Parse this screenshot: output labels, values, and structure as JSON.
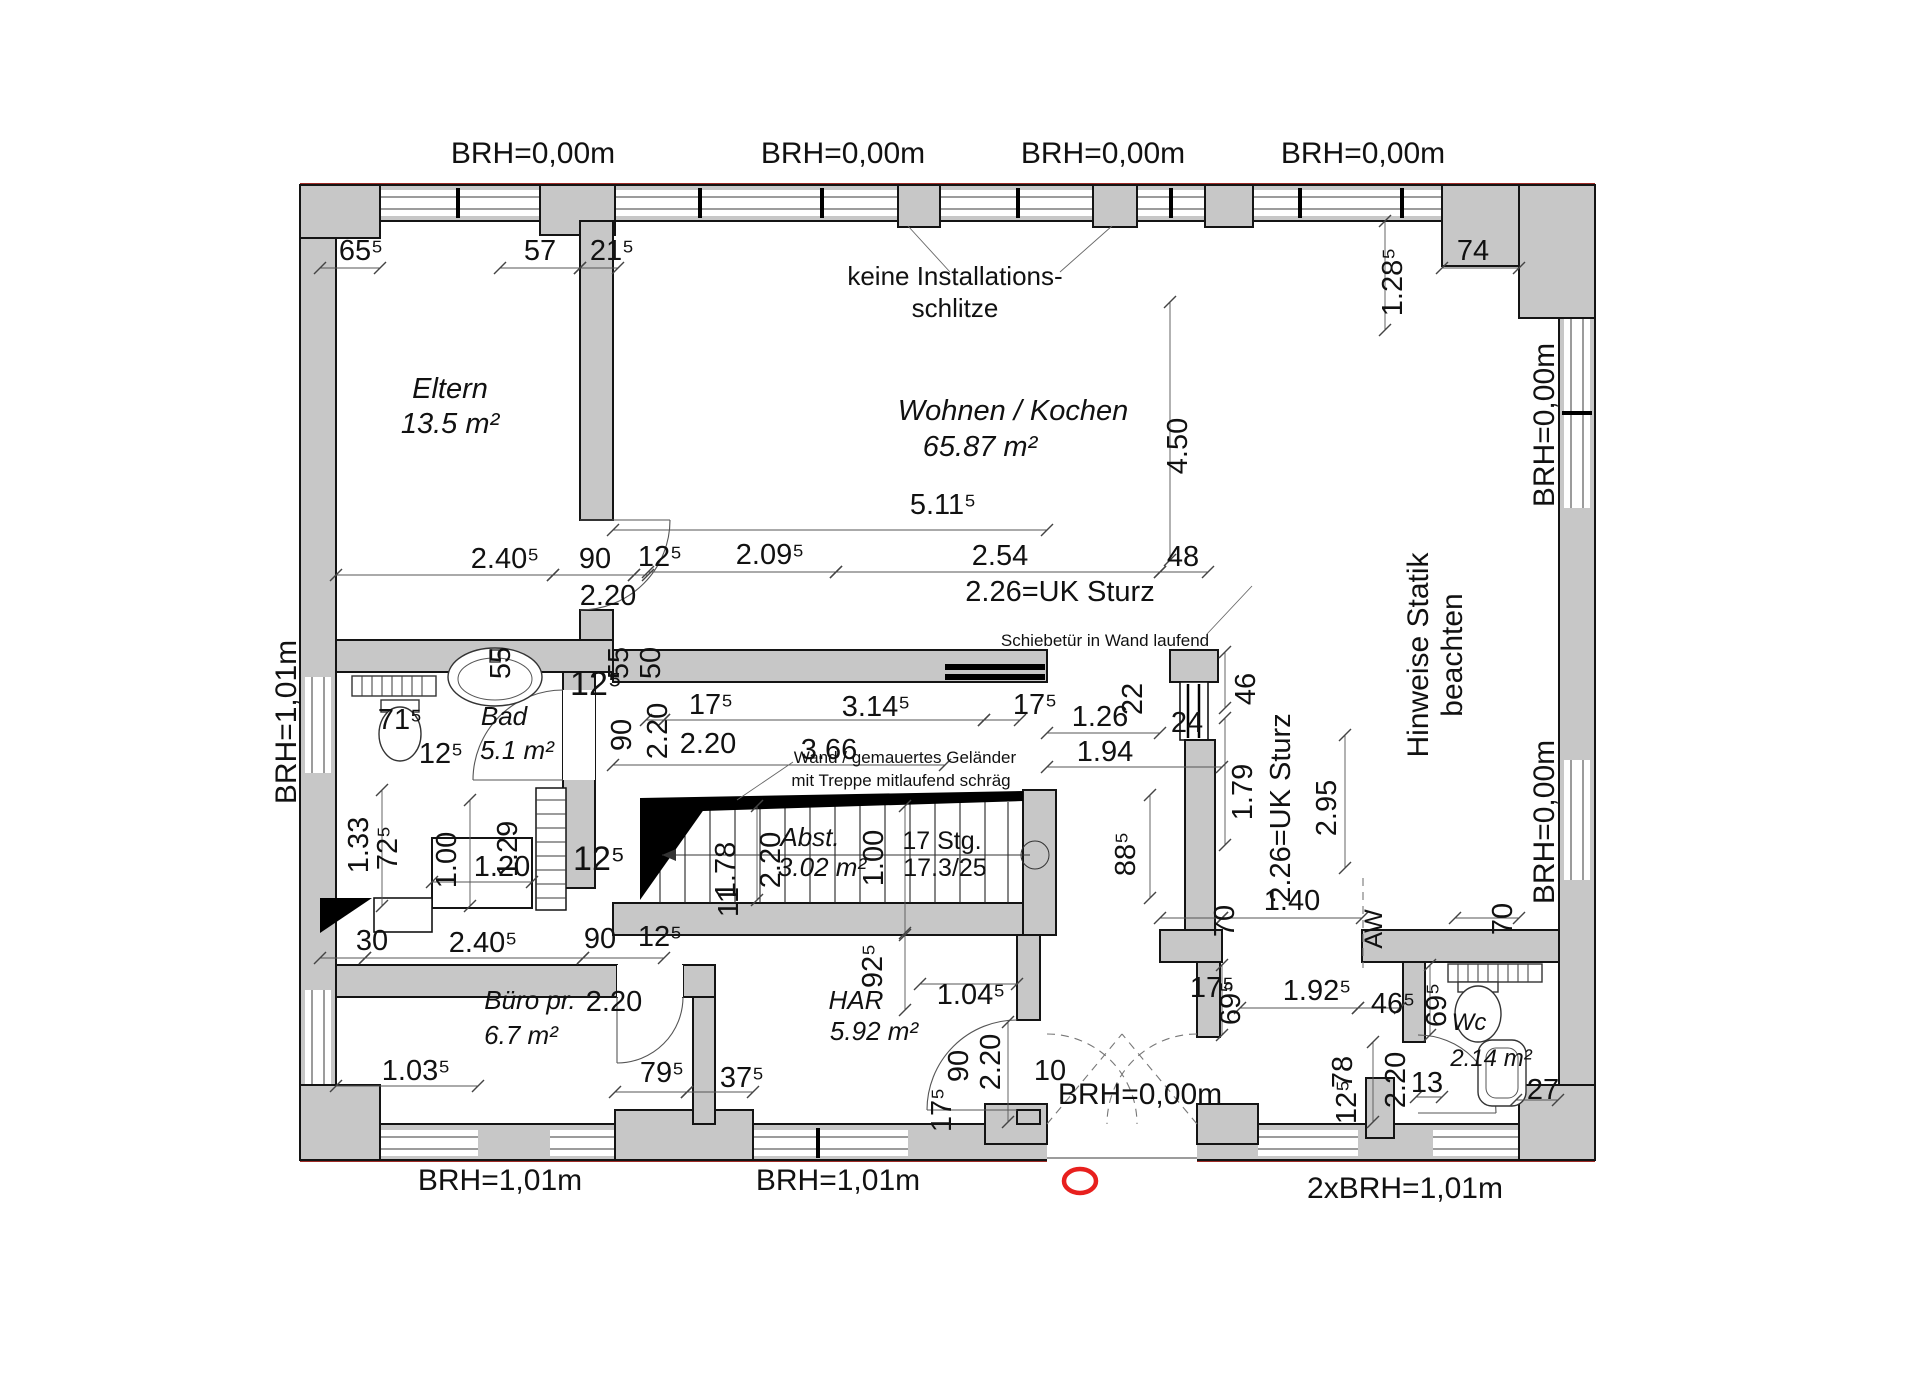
{
  "colors": {
    "wall_fill": "#c7c7c7",
    "outline": "#141414",
    "boundary_red": "#9e2b25",
    "marker_red": "#e8201e",
    "dim_line": "#555555"
  },
  "rooms": [
    {
      "name": "Eltern",
      "area": "13.5 m²"
    },
    {
      "name": "Wohnen / Kochen",
      "area": "65.87 m²"
    },
    {
      "name": "Bad",
      "area": "5.1 m²"
    },
    {
      "name": "Abst.",
      "area": "3.02 m²"
    },
    {
      "name": "Büro pr.",
      "area": "6.7 m²"
    },
    {
      "name": "HAR",
      "area": "5.92 m²"
    },
    {
      "name": "Wc",
      "area": "2.14 m²"
    }
  ],
  "stair": {
    "steps": "17 Stg.",
    "ratio": "17.3/25"
  },
  "notes": {
    "no_slits_line1": "keine Installations-",
    "no_slits_line2": "schlitze",
    "sliding_door": "Schiebetür in Wand laufend",
    "railing_line1": "Wand / gemauertes Geländer",
    "railing_line2": "mit Treppe mitlaufend schräg",
    "statics_line1": "Hinweise Statik",
    "statics_line2": "beachten",
    "existing_wall": "AW"
  },
  "brh": {
    "top_1": "BRH=0,00m",
    "top_2": "BRH=0,00m",
    "top_3": "BRH=0,00m",
    "top_4": "BRH=0,00m",
    "left": "BRH=1,01m",
    "right_upper": "BRH=0,00m",
    "right_lower": "BRH=0,00m",
    "bottom_1": "BRH=1,01m",
    "bottom_2": "BRH=1,01m",
    "bottom_entrance": "BRH=0,00m",
    "bottom_right": "2xBRH=1,01m"
  },
  "dims": [
    "65⁵",
    "57",
    "21⁵",
    "74",
    "1.28⁵",
    "4.50",
    "5.11⁵",
    "2.40⁵",
    "90",
    "12⁵",
    "2.20",
    "2.09⁵",
    "2.54",
    "48",
    "2.26=UK Sturz",
    "55",
    "71⁵",
    "12⁵",
    "12⁵",
    "55",
    "50",
    "90",
    "2.20",
    "17⁵",
    "3.14⁵",
    "17⁵",
    "2.20",
    "3.66",
    "1.26",
    "22",
    "24",
    "1.94",
    "46",
    "1.79",
    "2.26=UK Sturz",
    "2.95",
    "88⁵",
    "2.20",
    "1.78",
    "11",
    "1.00",
    "92⁵",
    "1.04⁵",
    "90",
    "12⁵",
    "2.20",
    "1.33",
    "72⁵",
    "1.00",
    "1.20",
    "1.29",
    "12⁵",
    "30",
    "2.40⁵",
    "1.03⁵",
    "79⁵",
    "37⁵",
    "17⁵",
    "90",
    "2.20",
    "10",
    "17⁵",
    "69⁵",
    "1.92⁵",
    "46⁵",
    "69⁵",
    "13",
    "27",
    "78",
    "12⁵",
    "2.20",
    "70",
    "1.40",
    "70"
  ]
}
